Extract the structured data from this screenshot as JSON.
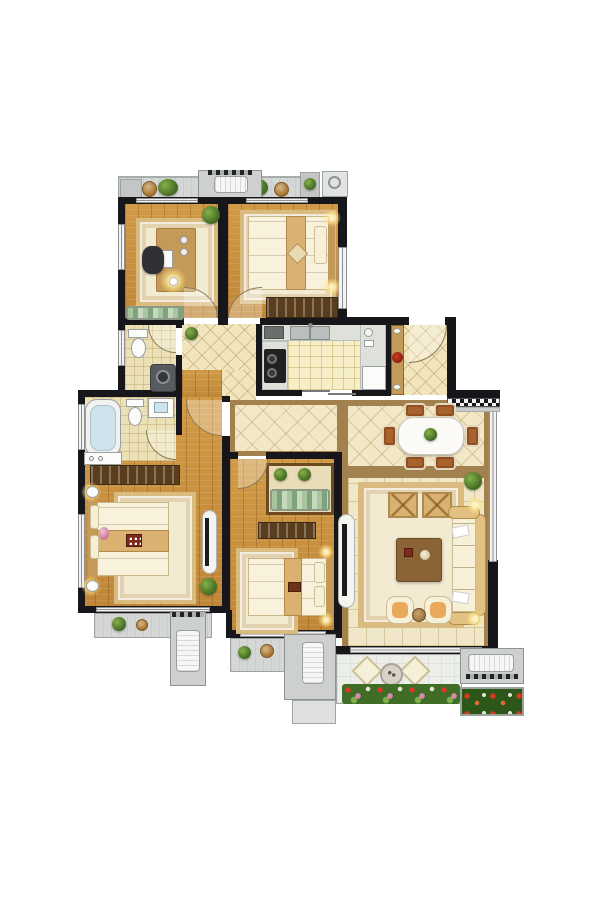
{
  "document": {
    "type": "residential floor plan",
    "view": "top-down color architectural rendering",
    "visible_text": ""
  },
  "palette": {
    "background": "#ffffff",
    "wall": "#17161a",
    "wood": "#c9913f",
    "tile": "#f1e5bd",
    "hall-tile": "#f3e8c6",
    "tile-border": "#a3814e",
    "bath-tile": "#ece1b6",
    "kitchen-tile": "#f6eec6",
    "counter": "#dde1da",
    "white-floor": "#eef0ea",
    "balcony": "#d5d7d6",
    "balcony-light": "#eceee8",
    "rug": "#f3ead2",
    "rug-border": "#d9bb80",
    "furn-wood": "#c49a58",
    "furn-wood-dark": "#8a6436",
    "wardrobe": "#5a3d1d",
    "fabric": "#d9b272",
    "cushion": "#f7f0d8",
    "mattress": "#f8f2dd",
    "sofa": "#e2c183",
    "seat-orange": "#e8a95c",
    "appliance": "#f4f4f0",
    "stove": "#222222",
    "tub": "#cfe3ed",
    "plant": "#4d7a2a",
    "flower-red": "#c83220",
    "lawn": "#2c5718",
    "glow": "#ffe9a8",
    "window": "#f2f2f2",
    "window-frame": "#8f8f8f",
    "door-arc": "#8a7a58"
  },
  "rooms": [
    {
      "name": "study",
      "floor": "wood",
      "furniture": [
        "desk",
        "office-chair",
        "rug",
        "table-lamp",
        "bench",
        "plant"
      ]
    },
    {
      "name": "bedroom-top-right",
      "floor": "wood",
      "furniture": [
        "double-bed",
        "rug",
        "wardrobe",
        "wall-lamps"
      ]
    },
    {
      "name": "guest-bathroom",
      "floor": "tile",
      "furniture": [
        "toilet",
        "washing-machine"
      ]
    },
    {
      "name": "kitchen",
      "floor": "tile",
      "furniture": [
        "double-sink",
        "cooktop",
        "counters",
        "fridge"
      ]
    },
    {
      "name": "entry-hall",
      "floor": "tile",
      "furniture": [
        "shoe-cabinet",
        "entry-door",
        "checker-threshold"
      ]
    },
    {
      "name": "corridor",
      "floor": "tile",
      "furniture": [
        "plant"
      ]
    },
    {
      "name": "master-bathroom",
      "floor": "tile",
      "furniture": [
        "bathtub",
        "toilet",
        "basin",
        "cabinet"
      ]
    },
    {
      "name": "master-bedroom",
      "floor": "wood",
      "furniture": [
        "double-bed",
        "rug",
        "wardrobe",
        "tv-stand",
        "nightstands",
        "plant"
      ]
    },
    {
      "name": "bedroom-bottom-middle",
      "floor": "wood",
      "furniture": [
        "double-bed",
        "rug",
        "wardrobe",
        "dresser-with-plants",
        "wall-lamps"
      ]
    },
    {
      "name": "dining-room",
      "floor": "tile",
      "furniture": [
        "dining-table",
        "six-chairs",
        "centerpiece",
        "plant"
      ]
    },
    {
      "name": "living-room",
      "floor": "tile",
      "furniture": [
        "sofa",
        "coffee-table",
        "rug",
        "two-armchairs",
        "two-ottomans",
        "tv-console",
        "wall-lamps"
      ]
    },
    {
      "name": "top-balcony",
      "floor": "deck",
      "furniture": [
        "plants",
        "ac-unit",
        "ac-platform"
      ]
    },
    {
      "name": "bottom-balcony",
      "floor": "deck",
      "furniture": [
        "two-cushions",
        "round-table",
        "flower-border"
      ]
    },
    {
      "name": "rear-balconies",
      "floor": "deck",
      "furniture": [
        "plants",
        "ac-units"
      ]
    },
    {
      "name": "flower-bed",
      "floor": "lawn",
      "furniture": [
        "flowers"
      ]
    }
  ]
}
